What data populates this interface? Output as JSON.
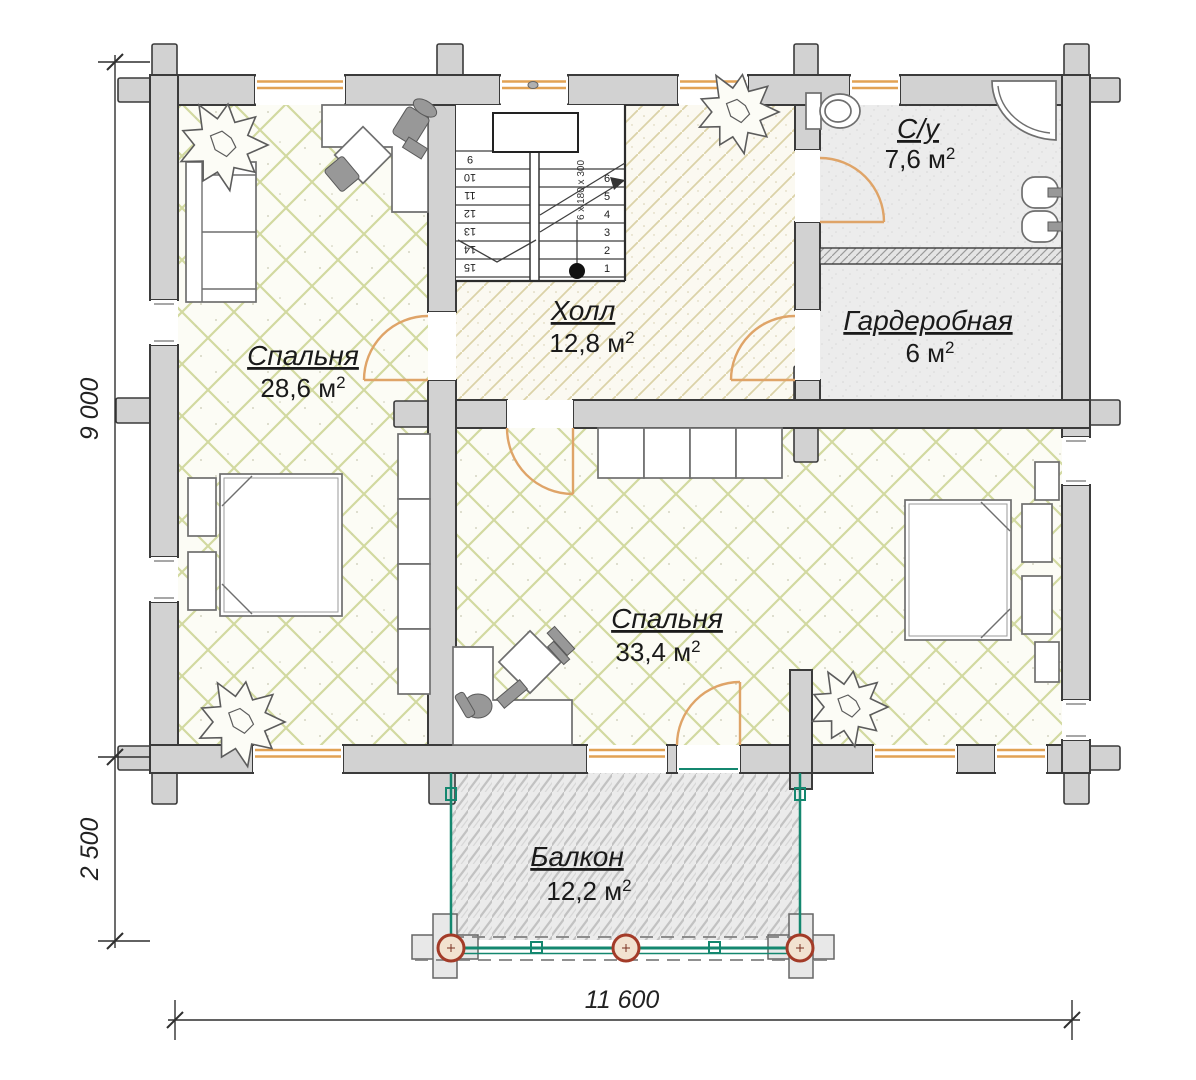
{
  "rooms": [
    {
      "name": "Спальня",
      "area": "28,6 м",
      "sup": "2"
    },
    {
      "name": "Холл",
      "area": "12,8 м",
      "sup": "2"
    },
    {
      "name": "С/у",
      "area": "7,6 м",
      "sup": "2"
    },
    {
      "name": "Гардеробная",
      "area": "6 м",
      "sup": "2"
    },
    {
      "name": "Спальня",
      "area": "33,4 м",
      "sup": "2"
    },
    {
      "name": "Балкон",
      "area": "12,2 м",
      "sup": "2"
    }
  ],
  "dimensions": {
    "left_upper": "9 000",
    "left_lower": "2 500",
    "bottom": "11 600"
  },
  "stairs": {
    "left_numbers": [
      "9",
      "10",
      "11",
      "12",
      "13",
      "14",
      "15"
    ],
    "right_numbers": [
      "6",
      "5",
      "4",
      "3",
      "2",
      "1"
    ],
    "spec": "6 х 180 х 300"
  },
  "colors": {
    "wall": "#d2d2d2",
    "wall_stroke": "#3b3b3b",
    "window": "#e2a254",
    "door": "#dfa468",
    "railing": "#14876f",
    "post_stroke": "#a33b28",
    "floor_hatch": "#d2d9a0",
    "hall_hatch": "#dbd2a8",
    "text": "#1a1a1a"
  }
}
